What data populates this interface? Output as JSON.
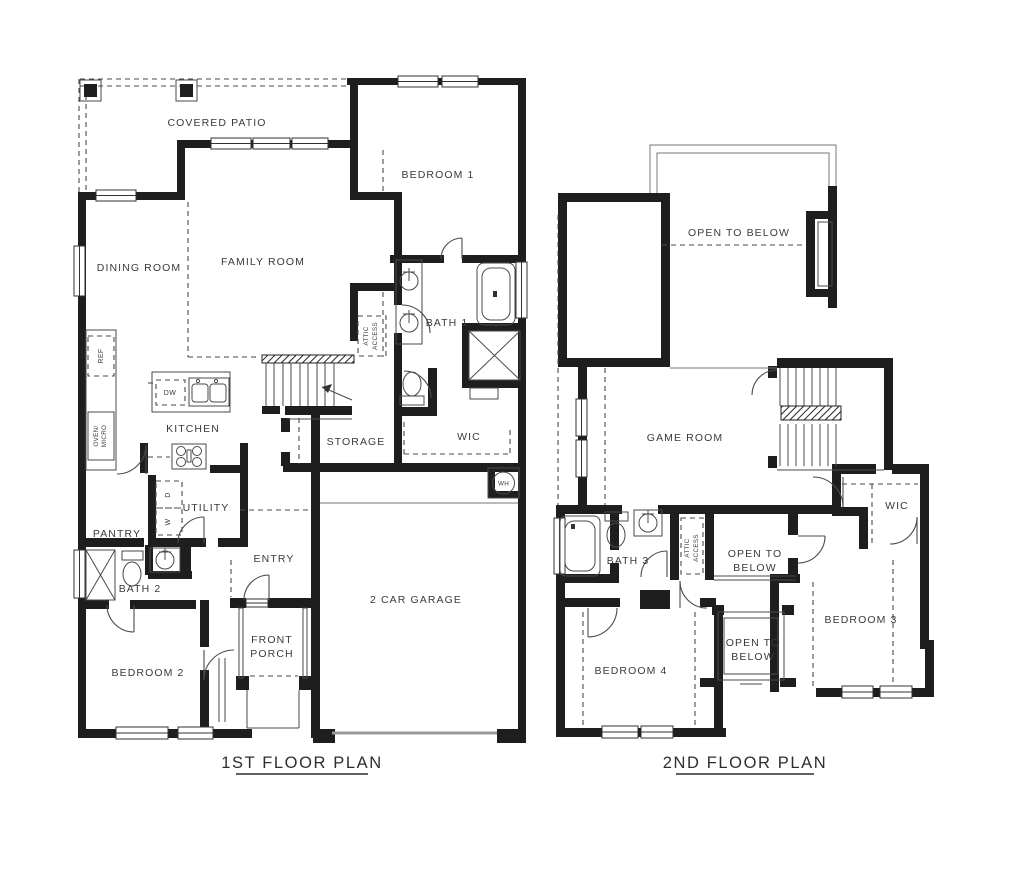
{
  "page": {
    "background": "#ffffff",
    "wall_color": "#1e1e1e",
    "text_color": "#3a3a3a"
  },
  "first_floor": {
    "title": "1ST FLOOR PLAN",
    "rooms": {
      "covered_patio": "COVERED PATIO",
      "bedroom1": "BEDROOM 1",
      "dining_room": "DINING ROOM",
      "family_room": "FAMILY ROOM",
      "bath1": "BATH 1",
      "kitchen": "KITCHEN",
      "storage": "STORAGE",
      "wic": "WIC",
      "utility": "UTILITY",
      "pantry": "PANTRY",
      "entry": "ENTRY",
      "bath2": "BATH 2",
      "bedroom2": "BEDROOM 2",
      "front_porch_line1": "FRONT",
      "front_porch_line2": "PORCH",
      "garage": "2 CAR GARAGE"
    },
    "fixtures": {
      "ref": "REF",
      "oven_line1": "OVEN/",
      "oven_line2": "MICRO",
      "dw": "DW",
      "dryer": "D",
      "washer": "W",
      "water_heater": "WH",
      "attic_line1": "ATTIC",
      "attic_line2": "ACCESS"
    }
  },
  "second_floor": {
    "title": "2ND FLOOR PLAN",
    "rooms": {
      "open_to_below_top": "OPEN TO BELOW",
      "game_room": "GAME ROOM",
      "bath3": "BATH 3",
      "open_mid_line1": "OPEN TO",
      "open_mid_line2": "BELOW",
      "wic": "WIC",
      "bedroom3": "BEDROOM 3",
      "bedroom4": "BEDROOM 4",
      "open_bottom_line1": "OPEN TO",
      "open_bottom_line2": "BELOW"
    },
    "fixtures": {
      "attic_line1": "ATTIC",
      "attic_line2": "ACCESS"
    }
  }
}
